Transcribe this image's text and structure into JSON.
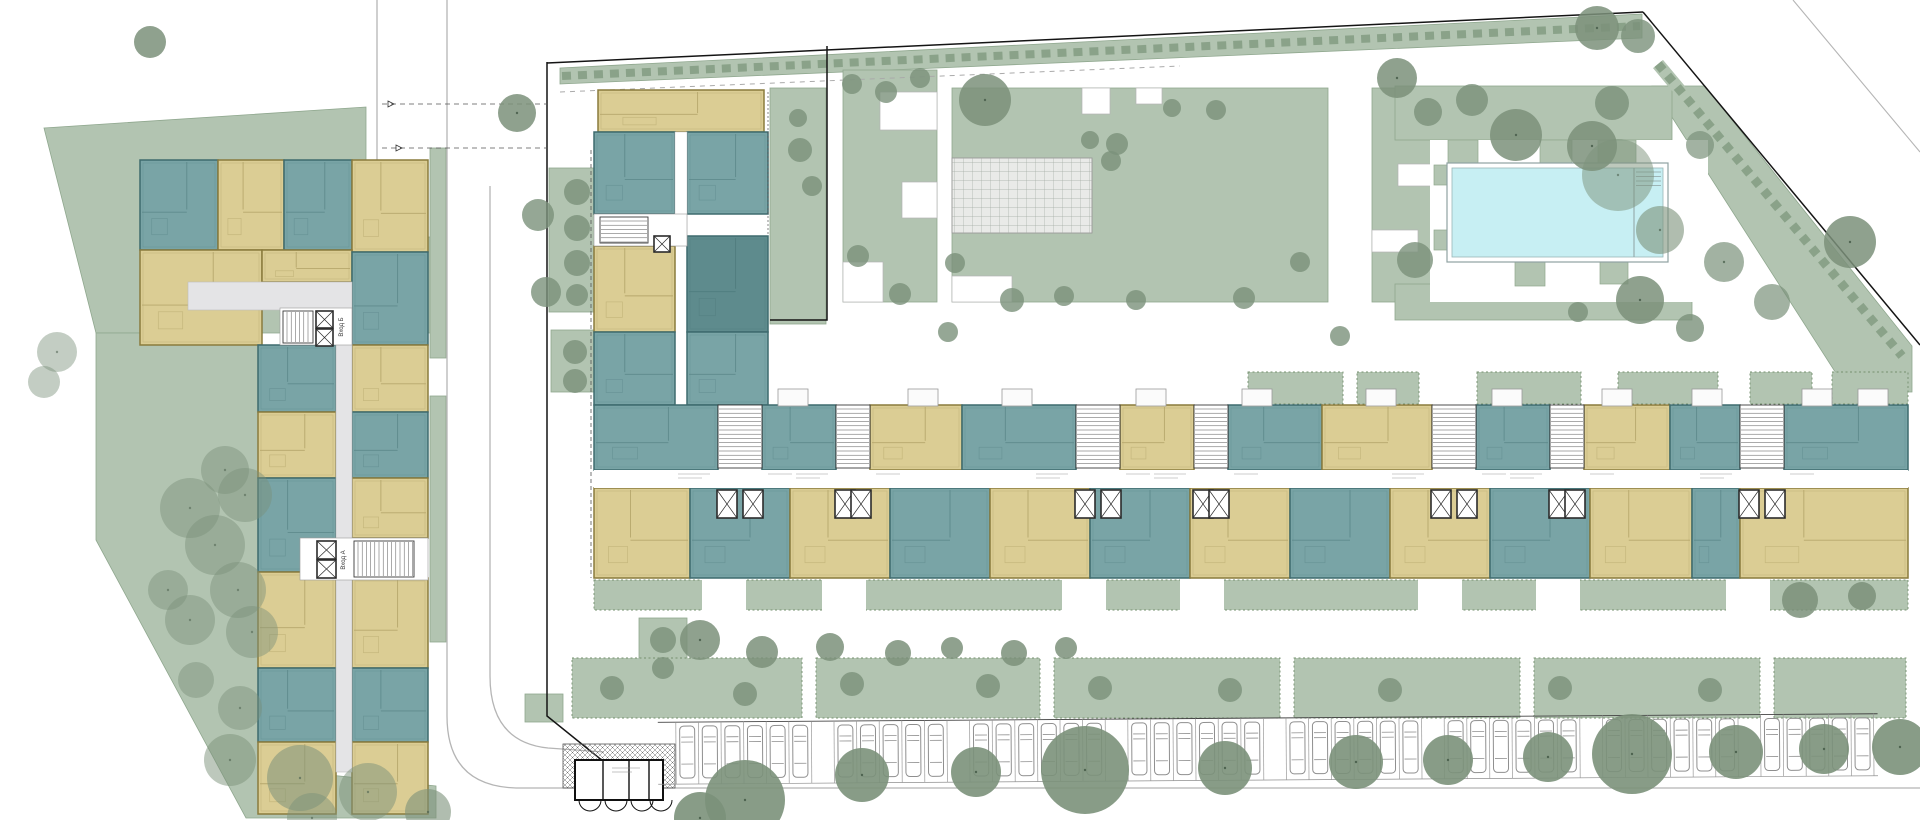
{
  "meta": {
    "title": "Residential complex — ground floor site plan"
  },
  "labels": {
    "entrance_a": "Вход А",
    "entrance_b": "Вход Б"
  },
  "colors": {
    "bg": "#ffffff",
    "sage": "#b2c4b1",
    "sageEdge": "#8fa78e",
    "hedgeDash": "#8aa289",
    "tree": "#7b917a",
    "teal": "#79a4a6",
    "tealStroke": "#3e6b6e",
    "tealDark": "#5e8b8d",
    "yellow": "#dbcd94",
    "yellowStroke": "#8a7b3d",
    "corridor": "#e4e4e6",
    "coreStroke": "#3a3a3a",
    "white": "#ffffff",
    "poolWater": "#c7eff3",
    "poolEdge": "#8fa2a2",
    "plazaFill": "#e9eae8",
    "plazaLine": "#a2aaa2",
    "curb": "#b5b5b5",
    "boundary": "#141414",
    "carStroke": "#8f8f8f"
  },
  "landscape": {
    "lawnPolys": [
      {
        "name": "left-lawn-upper",
        "pts": [
          [
            44,
            128
          ],
          [
            366,
            107
          ],
          [
            366,
            237
          ],
          [
            438,
            237
          ],
          [
            438,
            333
          ],
          [
            96,
            333
          ]
        ]
      },
      {
        "name": "left-lawn-lower",
        "pts": [
          [
            96,
            333
          ],
          [
            262,
            333
          ],
          [
            262,
            768
          ],
          [
            436,
            786
          ],
          [
            436,
            818
          ],
          [
            246,
            818
          ],
          [
            96,
            540
          ]
        ]
      },
      {
        "name": "corner-lawn-triangle",
        "pts": [
          [
            1652,
            86
          ],
          [
            1705,
            86
          ],
          [
            1912,
            346
          ],
          [
            1912,
            392
          ],
          [
            1848,
            392
          ]
        ]
      },
      {
        "name": "north-verge",
        "pts": [
          [
            560,
            68
          ],
          [
            1642,
            14
          ],
          [
            1642,
            38
          ],
          [
            560,
            84
          ]
        ]
      }
    ],
    "lawnRects": [
      [
        843,
        70,
        94,
        232
      ],
      [
        952,
        88,
        376,
        214
      ],
      [
        1372,
        88,
        62,
        214
      ],
      [
        1395,
        86,
        277,
        54
      ],
      [
        1395,
        284,
        297,
        36
      ],
      [
        549,
        168,
        56,
        144
      ],
      [
        551,
        330,
        52,
        62
      ],
      [
        430,
        148,
        16,
        210
      ],
      [
        430,
        396,
        16,
        246
      ],
      [
        770,
        88,
        56,
        236
      ],
      [
        525,
        694,
        38,
        28
      ],
      [
        639,
        618,
        48,
        68
      ]
    ],
    "deckTeeth": [
      [
        1448,
        140,
        30,
        36
      ],
      [
        1540,
        140,
        32,
        36
      ],
      [
        1598,
        140,
        38,
        28
      ],
      [
        1434,
        165,
        26,
        20
      ],
      [
        1434,
        230,
        14,
        20
      ],
      [
        1515,
        262,
        30,
        24
      ],
      [
        1600,
        262,
        28,
        22
      ]
    ],
    "pathNotches": [
      [
        880,
        92,
        57,
        38
      ],
      [
        902,
        182,
        35,
        36
      ],
      [
        843,
        262,
        40,
        40
      ],
      [
        1082,
        88,
        28,
        26
      ],
      [
        1136,
        88,
        26,
        16
      ],
      [
        952,
        276,
        60,
        26
      ],
      [
        1398,
        164,
        60,
        22
      ],
      [
        1372,
        230,
        46,
        22
      ]
    ],
    "gardenTop": [
      [
        1248,
        372,
        95,
        32
      ],
      [
        1357,
        372,
        62,
        32
      ],
      [
        1477,
        372,
        104,
        32
      ],
      [
        1618,
        372,
        100,
        32
      ],
      [
        1750,
        372,
        62,
        32
      ],
      [
        1832,
        372,
        76,
        32
      ]
    ],
    "hedgeBand": [
      594,
      580,
      1314,
      30
    ],
    "bandGaps": [
      [
        702,
        578,
        44,
        36
      ],
      [
        822,
        578,
        44,
        36
      ],
      [
        1062,
        578,
        44,
        36
      ],
      [
        1180,
        578,
        44,
        36
      ],
      [
        1418,
        578,
        44,
        36
      ],
      [
        1536,
        578,
        44,
        36
      ],
      [
        1726,
        578,
        44,
        36
      ]
    ],
    "gardenBottom": [
      [
        572,
        658,
        230,
        60
      ],
      [
        816,
        658,
        224,
        60
      ],
      [
        1054,
        658,
        226,
        60
      ],
      [
        1294,
        658,
        226,
        60
      ],
      [
        1534,
        658,
        226,
        60
      ],
      [
        1774,
        658,
        132,
        60
      ]
    ]
  },
  "plaza": {
    "x": 952,
    "y": 158,
    "w": 140,
    "h": 75
  },
  "pool": {
    "deck": [
      1430,
      140,
      278,
      162
    ],
    "rim": [
      1447,
      163,
      221,
      99
    ],
    "water": [
      1452,
      168,
      211,
      89
    ],
    "dividerX": 1634,
    "steps": {
      "x1": 1636,
      "x2": 1661,
      "ys": [
        172,
        176.5,
        181,
        185.5
      ]
    }
  },
  "streets": {
    "boundaries": [
      "M547,63 L1643,12",
      "M1643,12 L1920,345",
      "M547,62 V716 L614,770",
      "M827,46 V320 H770"
    ],
    "curbs": [
      "M447,0 V716 Q447,786 516,788 H1920",
      "M490,186 V676 Q490,742 548,748 L604,752",
      "M377,0 V160 Q377,186 352,186 H332"
    ],
    "vergeDash": [
      562,
      76,
      1640,
      26
    ],
    "grayDash": [
      560,
      92,
      1180,
      66
    ],
    "diagHedge": [
      1658,
      64,
      1902,
      356
    ],
    "outerRoad": "M1793,0 L1920,152",
    "driveDashes": [
      [
        382,
        104,
        548,
        104
      ],
      [
        382,
        148,
        548,
        148
      ]
    ],
    "arrows": [
      [
        388,
        104
      ],
      [
        396,
        148
      ]
    ]
  },
  "leftBuilding": {
    "units": [
      [
        140,
        160,
        78,
        90,
        "t"
      ],
      [
        218,
        160,
        66,
        90,
        "y"
      ],
      [
        284,
        160,
        68,
        90,
        "t"
      ],
      [
        352,
        160,
        76,
        92,
        "y"
      ],
      [
        140,
        250,
        122,
        95,
        "y"
      ],
      [
        262,
        250,
        90,
        32,
        "y"
      ],
      [
        352,
        252,
        76,
        93,
        "t"
      ],
      [
        258,
        345,
        78,
        67,
        "t"
      ],
      [
        258,
        412,
        78,
        66,
        "y"
      ],
      [
        258,
        478,
        78,
        94,
        "t"
      ],
      [
        258,
        572,
        78,
        96,
        "y"
      ],
      [
        258,
        668,
        78,
        74,
        "t"
      ],
      [
        258,
        742,
        78,
        72,
        "y"
      ],
      [
        352,
        345,
        76,
        67,
        "y"
      ],
      [
        352,
        412,
        76,
        66,
        "t"
      ],
      [
        352,
        478,
        76,
        60,
        "y"
      ],
      [
        352,
        578,
        76,
        90,
        "y"
      ],
      [
        352,
        668,
        76,
        74,
        "t"
      ],
      [
        352,
        742,
        76,
        72,
        "y"
      ]
    ],
    "corridors": [
      [
        188,
        282,
        164,
        28
      ],
      [
        336,
        310,
        16,
        462
      ]
    ],
    "cores": [
      {
        "rect": [
          280,
          308,
          72,
          37
        ],
        "stairs": [
          283,
          311,
          30,
          32,
          "v"
        ],
        "elevs": [
          [
            316,
            311,
            17,
            17
          ],
          [
            316,
            329,
            17,
            17
          ]
        ],
        "label": "entrance_b",
        "labelPos": [
          343,
          327
        ]
      },
      {
        "rect": [
          300,
          538,
          128,
          42
        ],
        "stairs": [
          354,
          541,
          60,
          36,
          "v"
        ],
        "elevs": [
          [
            317,
            541,
            19,
            18
          ],
          [
            317,
            560,
            19,
            18
          ]
        ],
        "label": "entrance_a",
        "labelPos": [
          345,
          560
        ]
      }
    ]
  },
  "mainBuilding": {
    "wingUnits": [
      [
        598,
        90,
        166,
        42,
        "y"
      ],
      [
        594,
        132,
        81,
        82,
        "t"
      ],
      [
        687,
        132,
        81,
        82,
        "t"
      ],
      [
        594,
        246,
        81,
        86,
        "y"
      ],
      [
        687,
        236,
        81,
        96,
        "d"
      ],
      [
        594,
        332,
        81,
        73,
        "t"
      ],
      [
        687,
        332,
        81,
        73,
        "t"
      ]
    ],
    "wingCorridor": [
      675,
      132,
      12,
      114
    ],
    "wingCore": {
      "rect": [
        594,
        214,
        93,
        32
      ],
      "stairs": [
        600,
        217,
        48,
        26,
        "h"
      ],
      "elev": [
        654,
        236,
        16,
        16
      ]
    },
    "topUnits": [
      [
        594,
        405,
        124,
        65,
        "t"
      ],
      [
        762,
        405,
        74,
        65,
        "t"
      ],
      [
        870,
        405,
        92,
        65,
        "y"
      ],
      [
        962,
        405,
        114,
        65,
        "t"
      ],
      [
        1120,
        405,
        74,
        65,
        "y"
      ],
      [
        1228,
        405,
        94,
        65,
        "t"
      ],
      [
        1322,
        405,
        110,
        65,
        "y"
      ],
      [
        1476,
        405,
        74,
        65,
        "t"
      ],
      [
        1584,
        405,
        86,
        65,
        "y"
      ],
      [
        1670,
        405,
        70,
        65,
        "t"
      ],
      [
        1784,
        405,
        124,
        65,
        "t"
      ]
    ],
    "bottomUnits": [
      [
        594,
        488,
        96,
        90,
        "y"
      ],
      [
        690,
        488,
        100,
        90,
        "t"
      ],
      [
        790,
        488,
        100,
        90,
        "y"
      ],
      [
        890,
        488,
        100,
        90,
        "t"
      ],
      [
        990,
        488,
        100,
        90,
        "y"
      ],
      [
        1090,
        488,
        100,
        90,
        "t"
      ],
      [
        1190,
        488,
        100,
        90,
        "y"
      ],
      [
        1290,
        488,
        100,
        90,
        "t"
      ],
      [
        1390,
        488,
        100,
        90,
        "y"
      ],
      [
        1490,
        488,
        100,
        90,
        "t"
      ],
      [
        1590,
        488,
        102,
        90,
        "y"
      ],
      [
        1692,
        488,
        48,
        90,
        "t"
      ],
      [
        1740,
        488,
        168,
        90,
        "y"
      ]
    ],
    "corridor": [
      594,
      470,
      1314,
      18
    ],
    "cores": [
      {
        "x": 718,
        "w": 44
      },
      {
        "x": 836,
        "w": 34
      },
      {
        "x": 1076,
        "w": 44
      },
      {
        "x": 1194,
        "w": 34
      },
      {
        "x": 1432,
        "w": 44
      },
      {
        "x": 1550,
        "w": 34
      },
      {
        "x": 1740,
        "w": 44
      }
    ],
    "coreY": 405,
    "coreH": 63,
    "elevY": 490,
    "balconies": [
      778,
      908,
      1002,
      1136,
      1242,
      1366,
      1492,
      1602,
      1692,
      1802,
      1858
    ]
  },
  "shelter": {
    "hatch": [
      563,
      744,
      112,
      44
    ],
    "box": [
      575,
      760,
      88,
      40
    ],
    "dividers": [
      603,
      629,
      649
    ],
    "arcCenters": [
      590,
      616,
      642,
      661
    ],
    "arcY": 800,
    "arcR": 11
  },
  "parking": {
    "x0": 676,
    "pitch": 22.6,
    "count": 53,
    "yTop": 718,
    "yBottom": 780,
    "emptyStalls": [
      6,
      12,
      19,
      26,
      33,
      40,
      47
    ],
    "tilt": -0.4
  },
  "trees": [
    [
      150,
      42,
      16,
      0.85
    ],
    [
      57,
      352,
      20,
      0.45
    ],
    [
      44,
      382,
      16,
      0.45
    ],
    [
      190,
      508,
      30,
      0.45
    ],
    [
      245,
      495,
      27,
      0.45
    ],
    [
      215,
      545,
      30,
      0.45
    ],
    [
      238,
      590,
      28,
      0.45
    ],
    [
      190,
      620,
      25,
      0.45
    ],
    [
      252,
      632,
      26,
      0.45
    ],
    [
      168,
      590,
      20,
      0.45
    ],
    [
      225,
      470,
      24,
      0.45
    ],
    [
      196,
      680,
      18,
      0.45
    ],
    [
      240,
      708,
      22,
      0.45
    ],
    [
      230,
      760,
      26,
      0.5
    ],
    [
      300,
      778,
      33,
      0.55
    ],
    [
      368,
      792,
      29,
      0.5
    ],
    [
      312,
      818,
      25,
      0.5
    ],
    [
      428,
      812,
      23,
      0.6
    ],
    [
      517,
      113,
      19,
      0.85
    ],
    [
      538,
      215,
      16,
      0.8
    ],
    [
      546,
      292,
      15,
      0.8
    ],
    [
      577,
      192,
      13,
      0.8
    ],
    [
      577,
      228,
      13,
      0.8
    ],
    [
      577,
      263,
      13,
      0.8
    ],
    [
      577,
      295,
      11,
      0.8
    ],
    [
      575,
      352,
      12,
      0.8
    ],
    [
      575,
      381,
      12,
      0.8
    ],
    [
      663,
      640,
      13,
      0.8
    ],
    [
      663,
      668,
      11,
      0.8
    ],
    [
      800,
      150,
      12,
      0.8
    ],
    [
      812,
      186,
      10,
      0.8
    ],
    [
      798,
      118,
      9,
      0.8
    ],
    [
      852,
      84,
      10,
      0.8
    ],
    [
      886,
      92,
      11,
      0.8
    ],
    [
      920,
      78,
      10,
      0.8
    ],
    [
      858,
      256,
      11,
      0.8
    ],
    [
      900,
      294,
      11,
      0.8
    ],
    [
      985,
      100,
      26,
      0.85
    ],
    [
      1090,
      140,
      9,
      0.8
    ],
    [
      1117,
      144,
      11,
      0.8
    ],
    [
      1111,
      161,
      10,
      0.8
    ],
    [
      1172,
      108,
      9,
      0.8
    ],
    [
      1216,
      110,
      10,
      0.8
    ],
    [
      955,
      263,
      10,
      0.8
    ],
    [
      1012,
      300,
      12,
      0.8
    ],
    [
      1064,
      296,
      10,
      0.8
    ],
    [
      1136,
      300,
      10,
      0.8
    ],
    [
      1244,
      298,
      11,
      0.8
    ],
    [
      1300,
      262,
      10,
      0.8
    ],
    [
      1397,
      78,
      20,
      0.85
    ],
    [
      1428,
      112,
      14,
      0.8
    ],
    [
      1472,
      100,
      16,
      0.8
    ],
    [
      1516,
      135,
      26,
      0.85
    ],
    [
      1592,
      146,
      25,
      0.85
    ],
    [
      1612,
      103,
      17,
      0.8
    ],
    [
      1415,
      260,
      18,
      0.8
    ],
    [
      1640,
      300,
      24,
      0.85
    ],
    [
      1578,
      312,
      10,
      0.8
    ],
    [
      1690,
      328,
      14,
      0.8
    ],
    [
      1597,
      28,
      22,
      0.85
    ],
    [
      1638,
      36,
      17,
      0.8
    ],
    [
      1618,
      175,
      36,
      0.5
    ],
    [
      1660,
      230,
      24,
      0.6
    ],
    [
      1724,
      262,
      20,
      0.7
    ],
    [
      1700,
      145,
      14,
      0.7
    ],
    [
      1772,
      302,
      18,
      0.7
    ],
    [
      1850,
      242,
      26,
      0.85
    ],
    [
      948,
      332,
      10,
      0.8
    ],
    [
      1340,
      336,
      10,
      0.8
    ],
    [
      700,
      640,
      20,
      0.85
    ],
    [
      762,
      652,
      16,
      0.85
    ],
    [
      830,
      647,
      14,
      0.85
    ],
    [
      898,
      653,
      13,
      0.85
    ],
    [
      952,
      648,
      11,
      0.85
    ],
    [
      1014,
      653,
      13,
      0.85
    ],
    [
      1066,
      648,
      11,
      0.85
    ],
    [
      612,
      688,
      12,
      0.8
    ],
    [
      745,
      694,
      12,
      0.8
    ],
    [
      852,
      684,
      12,
      0.8
    ],
    [
      988,
      686,
      12,
      0.8
    ],
    [
      1100,
      688,
      12,
      0.8
    ],
    [
      1230,
      690,
      12,
      0.8
    ],
    [
      1390,
      690,
      12,
      0.8
    ],
    [
      1560,
      688,
      12,
      0.8
    ],
    [
      1710,
      690,
      12,
      0.8
    ],
    [
      1800,
      600,
      18,
      0.85
    ],
    [
      1862,
      596,
      14,
      0.85
    ],
    [
      745,
      800,
      40,
      0.9
    ],
    [
      700,
      818,
      26,
      0.9
    ],
    [
      862,
      775,
      27,
      0.9
    ],
    [
      976,
      772,
      25,
      0.9
    ],
    [
      1085,
      770,
      44,
      0.9
    ],
    [
      1225,
      768,
      27,
      0.9
    ],
    [
      1356,
      762,
      27,
      0.9
    ],
    [
      1448,
      760,
      25,
      0.9
    ],
    [
      1548,
      757,
      25,
      0.9
    ],
    [
      1632,
      754,
      40,
      0.9
    ],
    [
      1736,
      752,
      27,
      0.9
    ],
    [
      1824,
      749,
      25,
      0.9
    ],
    [
      1900,
      747,
      28,
      0.9
    ]
  ]
}
